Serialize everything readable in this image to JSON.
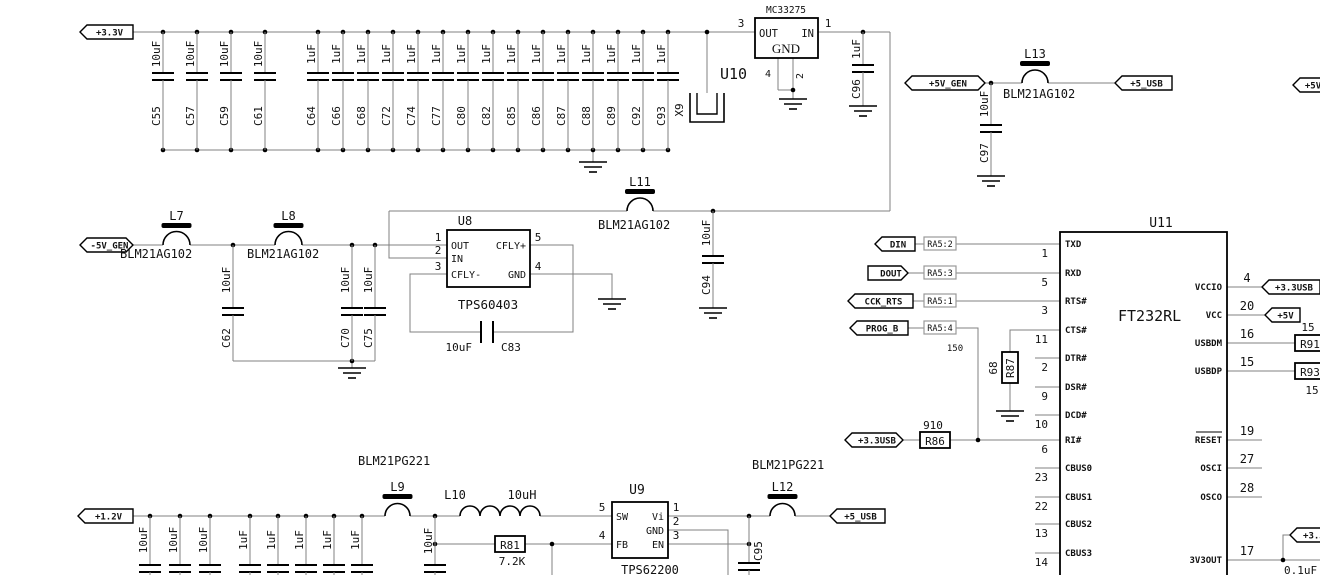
{
  "nets": {
    "p3v3": "+3.3V",
    "n5v_gen": "-5V_GEN",
    "p5v_gen": "+5V_GEN",
    "p5_usb_top": "+5_USB",
    "p5v_edge": "+5V",
    "din": "DIN",
    "dout": "DOUT",
    "cck_rts": "CCK_RTS",
    "prog_b": "PROG_B",
    "p3v3usb_r86": "+3.3USB",
    "p3v3usb_vccio": "+3.3USB",
    "p5v_vcc": "+5V",
    "p1v2": "+1.2V",
    "p5_usb_bottom": "+5_USB",
    "p3v3usb_3v3out": "+3.3USB"
  },
  "top_cap_bank": {
    "caps": [
      {
        "ref": "C55",
        "value": "10uF"
      },
      {
        "ref": "C57",
        "value": "10uF"
      },
      {
        "ref": "C59",
        "value": "10uF"
      },
      {
        "ref": "C61",
        "value": "10uF"
      },
      {
        "ref": "C64",
        "value": "1uF"
      },
      {
        "ref": "C66",
        "value": "1uF"
      },
      {
        "ref": "C68",
        "value": "1uF"
      },
      {
        "ref": "C72",
        "value": "1uF"
      },
      {
        "ref": "C74",
        "value": "1uF"
      },
      {
        "ref": "C77",
        "value": "1uF"
      },
      {
        "ref": "C80",
        "value": "1uF"
      },
      {
        "ref": "C82",
        "value": "1uF"
      },
      {
        "ref": "C85",
        "value": "1uF"
      },
      {
        "ref": "C86",
        "value": "1uF"
      },
      {
        "ref": "C87",
        "value": "1uF"
      },
      {
        "ref": "C88",
        "value": "1uF"
      },
      {
        "ref": "C89",
        "value": "1uF"
      },
      {
        "ref": "C92",
        "value": "1uF"
      },
      {
        "ref": "C93",
        "value": "1uF"
      }
    ]
  },
  "bottom_cap_bank": {
    "values": [
      "10uF",
      "10uF",
      "10uF",
      "1uF",
      "1uF",
      "1uF",
      "1uF",
      "1uF"
    ]
  },
  "inductors": {
    "l7": {
      "ref": "L7",
      "part": "BLM21AG102"
    },
    "l8": {
      "ref": "L8",
      "part": "BLM21AG102"
    },
    "l11": {
      "ref": "L11",
      "part": "BLM21AG102"
    },
    "l13": {
      "ref": "L13",
      "part": "BLM21AG102"
    },
    "l9": {
      "ref": "L9",
      "part": "BLM21PG221"
    },
    "l12": {
      "ref": "L12",
      "part": "BLM21PG221"
    },
    "l10": {
      "ref": "L10",
      "value": "10uH"
    }
  },
  "capacitors": {
    "c96": {
      "ref": "C96",
      "value": "1uF"
    },
    "c97": {
      "ref": "C97",
      "value": "10uF"
    },
    "c62": {
      "ref": "C62",
      "value": "10uF"
    },
    "c70": {
      "ref": "C70",
      "value": "10uF"
    },
    "c75": {
      "ref": "C75",
      "value": "10uF"
    },
    "c94": {
      "ref": "C94",
      "value": "10uF"
    },
    "c83": {
      "ref": "C83",
      "value": "10uF"
    },
    "c95": {
      "ref": "C95"
    },
    "c_3v3out_value": "0.1uF"
  },
  "resistors": {
    "r86": {
      "ref": "R86",
      "value": "910"
    },
    "r87": {
      "ref": "R87",
      "value": "68"
    },
    "r81": {
      "ref": "R81",
      "value": "7.2K"
    },
    "r91": {
      "ref": "R91",
      "value": "15"
    },
    "r93": {
      "ref": "R93",
      "value": "15"
    },
    "ra5_value": "150"
  },
  "ra5": [
    {
      "label": "RA5:2"
    },
    {
      "label": "RA5:3"
    },
    {
      "label": "RA5:1"
    },
    {
      "label": "RA5:4"
    }
  ],
  "u10": {
    "ref": "U10",
    "part": "MC33275",
    "pin_out": "OUT",
    "pin_in": "IN",
    "pin_gnd": "GND",
    "num_out": "3",
    "num_in": "1",
    "num_gnd1": "4",
    "num_gnd2": "2"
  },
  "u8": {
    "ref": "U8",
    "part": "TPS60403",
    "pin_out": "OUT",
    "pin_in": "IN",
    "pin_cfly_minus": "CFLY-",
    "pin_cfly_plus": "CFLY+",
    "pin_gnd": "GND",
    "num1": "1",
    "num2": "2",
    "num3": "3",
    "num4": "4",
    "num5": "5"
  },
  "u9": {
    "ref": "U9",
    "part": "TPS62200",
    "pin_sw": "SW",
    "pin_vi": "Vi",
    "pin_gnd": "GND",
    "pin_fb": "FB",
    "pin_en": "EN",
    "num_sw": "5",
    "num_fb": "4",
    "num_vi": "1",
    "num_gnd": "2",
    "num_en": "3"
  },
  "u11": {
    "ref": "U11",
    "part": "FT232RL",
    "left_pins": [
      {
        "name": "TXD",
        "num": "1"
      },
      {
        "name": "RXD",
        "num": "5"
      },
      {
        "name": "RTS#",
        "num": "3"
      },
      {
        "name": "CTS#",
        "num": "11"
      },
      {
        "name": "DTR#",
        "num": "2"
      },
      {
        "name": "DSR#",
        "num": "9"
      },
      {
        "name": "DCD#",
        "num": "10"
      },
      {
        "name": "RI#",
        "num": "6"
      },
      {
        "name": "CBUS0",
        "num": "23"
      },
      {
        "name": "CBUS1",
        "num": "22"
      },
      {
        "name": "CBUS2",
        "num": "13"
      },
      {
        "name": "CBUS3",
        "num": "14"
      }
    ],
    "right_pins": [
      {
        "name": "VCCIO",
        "num": "4"
      },
      {
        "name": "VCC",
        "num": "20"
      },
      {
        "name": "USBDM",
        "num": "16"
      },
      {
        "name": "USBDP",
        "num": "15"
      },
      {
        "name": "RESET",
        "num": "19"
      },
      {
        "name": "OSCI",
        "num": "27"
      },
      {
        "name": "OSCO",
        "num": "28"
      },
      {
        "name": "3V3OUT",
        "num": "17"
      }
    ]
  },
  "x9": {
    "ref": "X9"
  },
  "colors": {
    "wire": "#808080",
    "symbol": "#000000",
    "muted": "#777777"
  }
}
